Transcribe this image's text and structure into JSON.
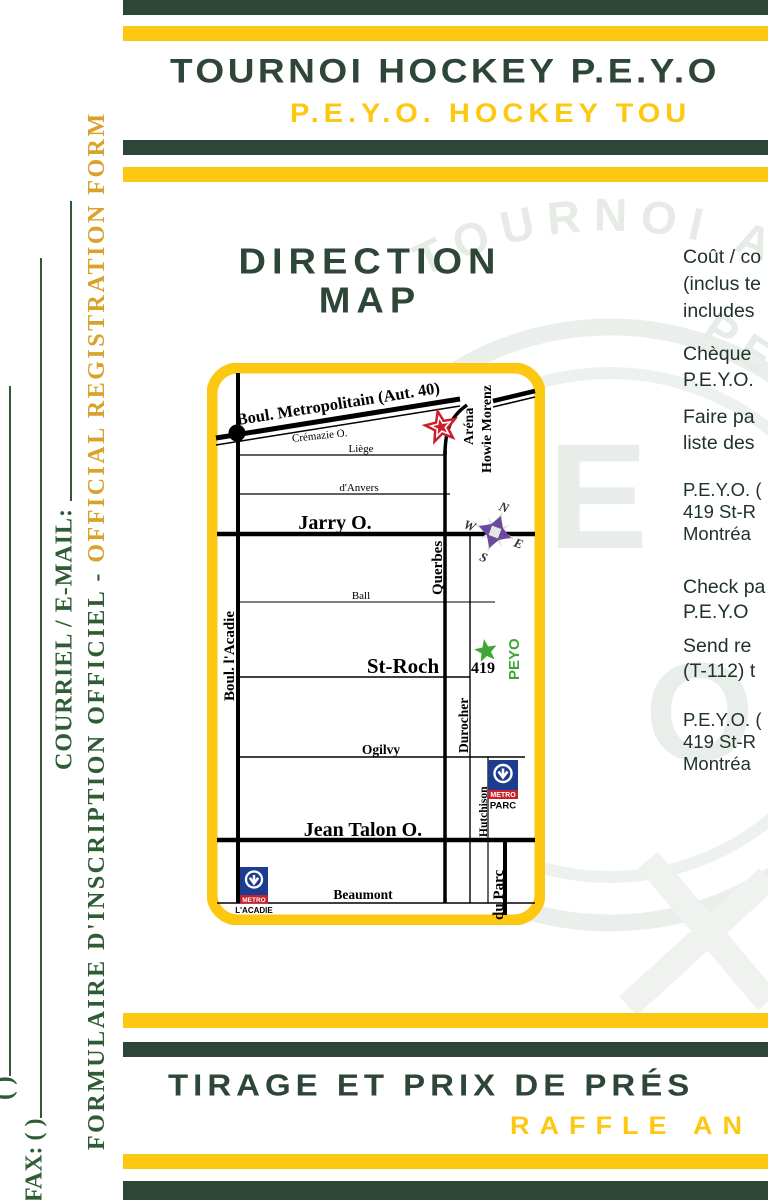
{
  "colors": {
    "dark_green": "#2d4638",
    "yellow": "#fcc811",
    "sidebar_green": "#2f5c34",
    "sidebar_gold": "#d9a22b",
    "star_red": "#c9202b",
    "star_green": "#3fa535",
    "compass_purple": "#6b4a9e",
    "metro_blue": "#1d3c8f",
    "metro_red": "#c9202b"
  },
  "sidebar": {
    "cut_field_parens": "(       )",
    "fax_label": "FAX: (         )",
    "email_label": "COURRIEL / E-MAIL:",
    "form_label_fr": "FORMULAIRE D'INSCRIPTION OFFICIEL - ",
    "form_label_en": "OFFICIAL REGISTRATION FORM"
  },
  "header": {
    "title": "TOURNOI HOCKEY P.E.Y.O",
    "subtitle": "P.E.Y.O. HOCKEY TOU"
  },
  "map_section": {
    "title_line1": "DIRECTION",
    "title_line2": "MAP",
    "streets": {
      "metropolitain": "Boul. Metropolitain (Aut. 40)",
      "cremazie": "Crémazie O.",
      "liege": "Liège",
      "danvers": "d'Anvers",
      "jarry": "Jarry O.",
      "ball": "Ball",
      "st_roch": "St-Roch",
      "ogilvy": "Ogilvy",
      "jean_talon": "Jean Talon O.",
      "beaumont": "Beaumont",
      "acadie": "Boul. l'Acadie",
      "querbes": "Querbes",
      "durocher": "Durocher",
      "hutchison": "Hutchison",
      "du_parc": "du Parc"
    },
    "arena_line1": "Aréna",
    "arena_line2": "Howie Morenz",
    "peyo_number": "419",
    "peyo_label": "PEYO",
    "compass": {
      "n": "N",
      "e": "E",
      "s": "S",
      "w": "W"
    },
    "metro_parc": {
      "metro": "METRO",
      "station": "PARC"
    },
    "metro_acadie": {
      "metro": "METRO",
      "station": "L'ACADIE"
    }
  },
  "info_column": {
    "p1": [
      "Coût / co",
      "(inclus te",
      "includes"
    ],
    "p2": [
      "Chèque",
      "P.E.Y.O."
    ],
    "p3": [
      "Faire pa",
      "liste des"
    ],
    "p4": [
      "P.E.Y.O. (",
      "419 St-R",
      "Montréa"
    ],
    "p5": [
      "Check pa",
      "P.E.Y.O"
    ],
    "p6": [
      "Send  re",
      "(T-112) t"
    ],
    "p7": [
      "P.E.Y.O. (",
      "419 St-R",
      "Montréa"
    ]
  },
  "footer": {
    "title": "TIRAGE ET PRIX DE PRÉS",
    "subtitle": "RAFFLE AN"
  },
  "watermark": {
    "arc_text": "TOURNOI AT",
    "arc_text2": "PEEW",
    "letter_e": "E",
    "letter_o": "O"
  }
}
